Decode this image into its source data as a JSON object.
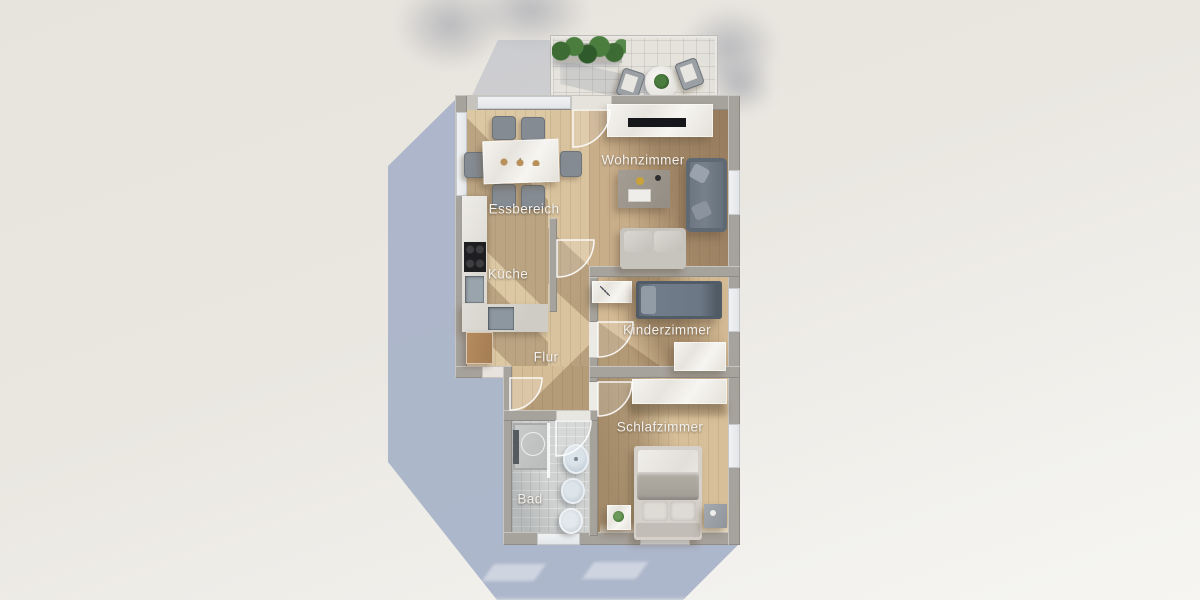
{
  "rooms": [
    {
      "id": "wohnzimmer",
      "label": "Wohnzimmer"
    },
    {
      "id": "essbereich",
      "label": "Essbereich"
    },
    {
      "id": "kueche",
      "label": "Küche"
    },
    {
      "id": "kinderzimmer",
      "label": "Kinderzimmer"
    },
    {
      "id": "flur",
      "label": "Flur"
    },
    {
      "id": "schlafzimmer",
      "label": "Schlafzimmer"
    },
    {
      "id": "bad",
      "label": "Bad"
    }
  ],
  "colors": {
    "background": "#eae7e1",
    "cast_shadow": "#a8b2c8",
    "wall": "#a6a29c",
    "wood_light": "#ddc7a3",
    "wood_dark": "#9b7f61",
    "bath_tile": "#d0d2d1",
    "marble": "#f1efeb",
    "plant_green": "#4a7d3e",
    "label_text": "#f3f1ed"
  }
}
